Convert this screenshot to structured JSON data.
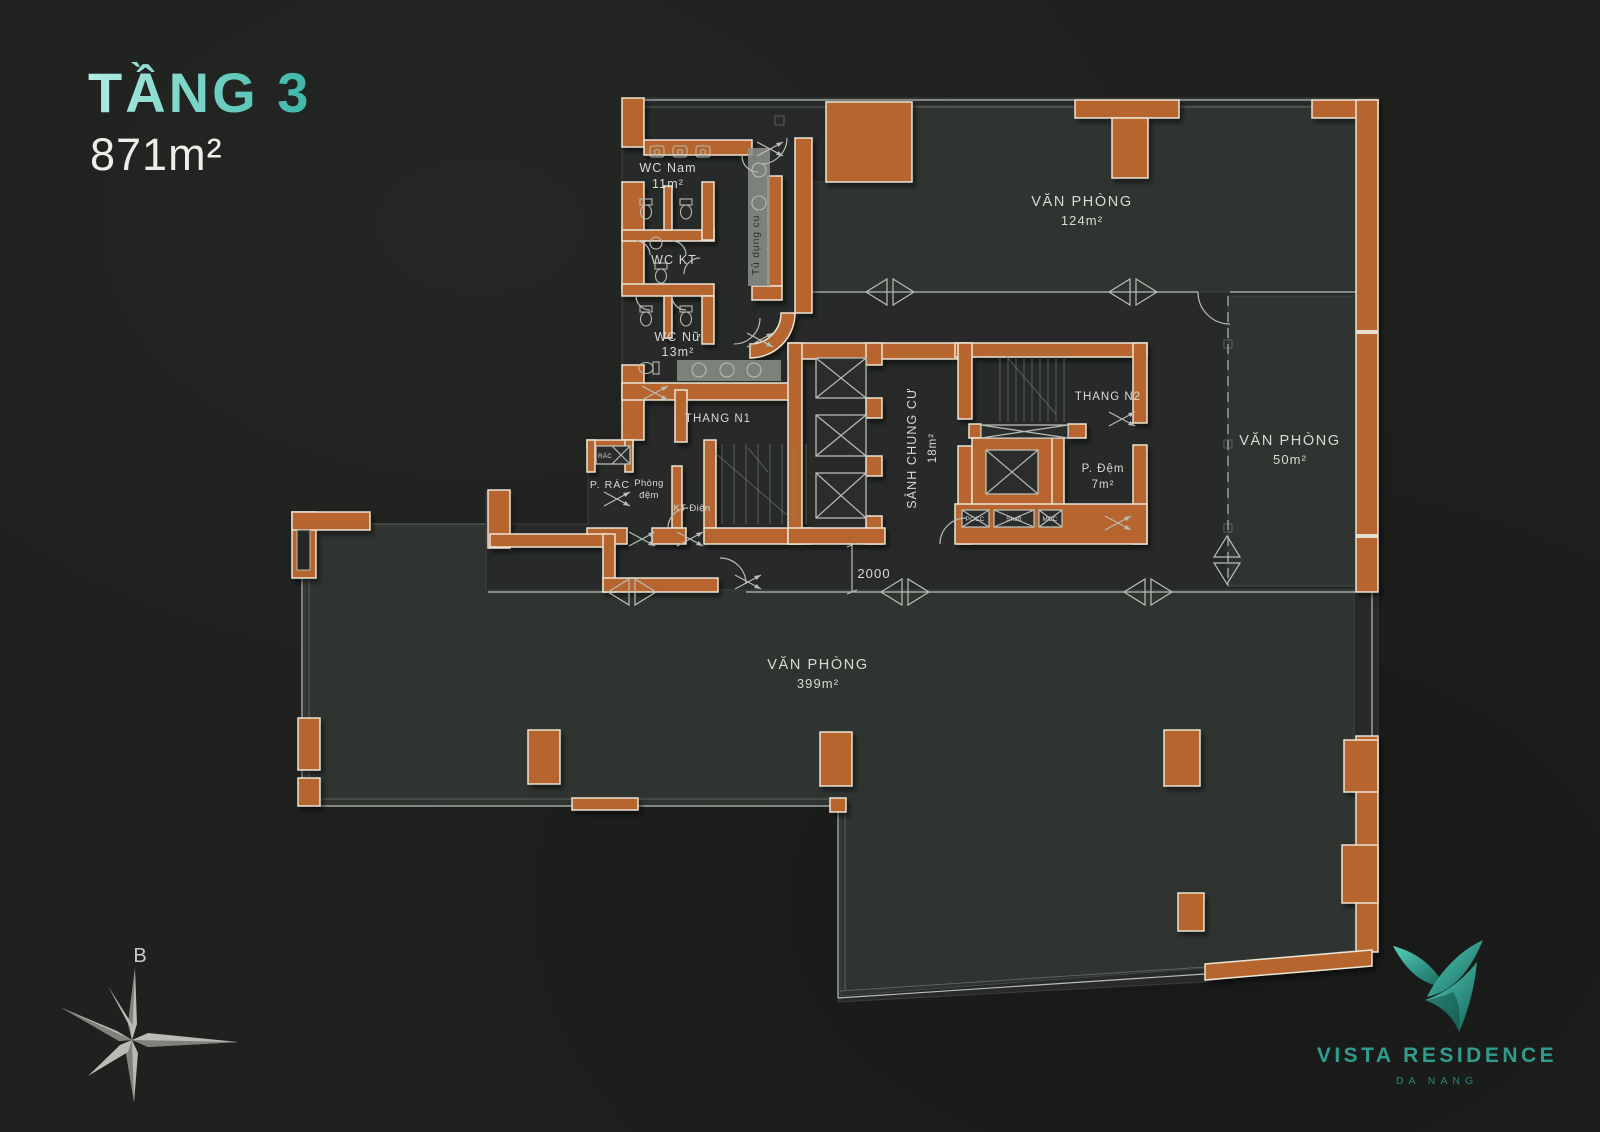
{
  "header": {
    "floor_title": "TẦNG 3",
    "floor_area": "871m²"
  },
  "plan": {
    "rooms": {
      "wc_nam": {
        "label": "WC Nam",
        "area": "11m²"
      },
      "wc_kt": {
        "label": "WC KT"
      },
      "wc_nu": {
        "label": "WC Nữ",
        "area": "13m²"
      },
      "tu_dung_cu": {
        "label": "Tủ dụng cụ"
      },
      "van_phong_124": {
        "label": "VĂN PHÒNG",
        "area": "124m²"
      },
      "thang_n1": {
        "label": "THANG N1"
      },
      "thang_n2": {
        "label": "THANG N2"
      },
      "sanh_chung_cu": {
        "label": "SẢNH CHUNG CƯ",
        "area": "18m²"
      },
      "p_dem": {
        "label": "P. Đệm",
        "area": "7m²"
      },
      "van_phong_50": {
        "label": "VĂN PHÒNG",
        "area": "50m²"
      },
      "p_rac": {
        "label": "P. RÁC"
      },
      "rac_shaft": {
        "label": "RÁC"
      },
      "phong_dem": {
        "line1": "Phòng",
        "line2": "đệm"
      },
      "kt_dien": {
        "label": "KT Điện"
      },
      "van_phong_399": {
        "label": "VĂN PHÒNG",
        "area": "399m²"
      },
      "pccc_shaft": {
        "label": "PCCC"
      },
      "shaft": {
        "label": "Shaft"
      },
      "mcc_shaft": {
        "label": "MCC"
      }
    },
    "dimensions": {
      "corridor_width": "2000"
    },
    "compass": {
      "north_label": "B"
    }
  },
  "branding": {
    "name": "VISTA RESIDENCE",
    "location": "DA NANG"
  },
  "colors": {
    "accent_teal": "#3fbfae",
    "wall_orange": "#b5652d",
    "background": "#1f211f",
    "floor_light": "#2f3431",
    "floor_dark": "#272a28",
    "line_light": "#b9bdb6",
    "text_light": "#d8dad3"
  }
}
